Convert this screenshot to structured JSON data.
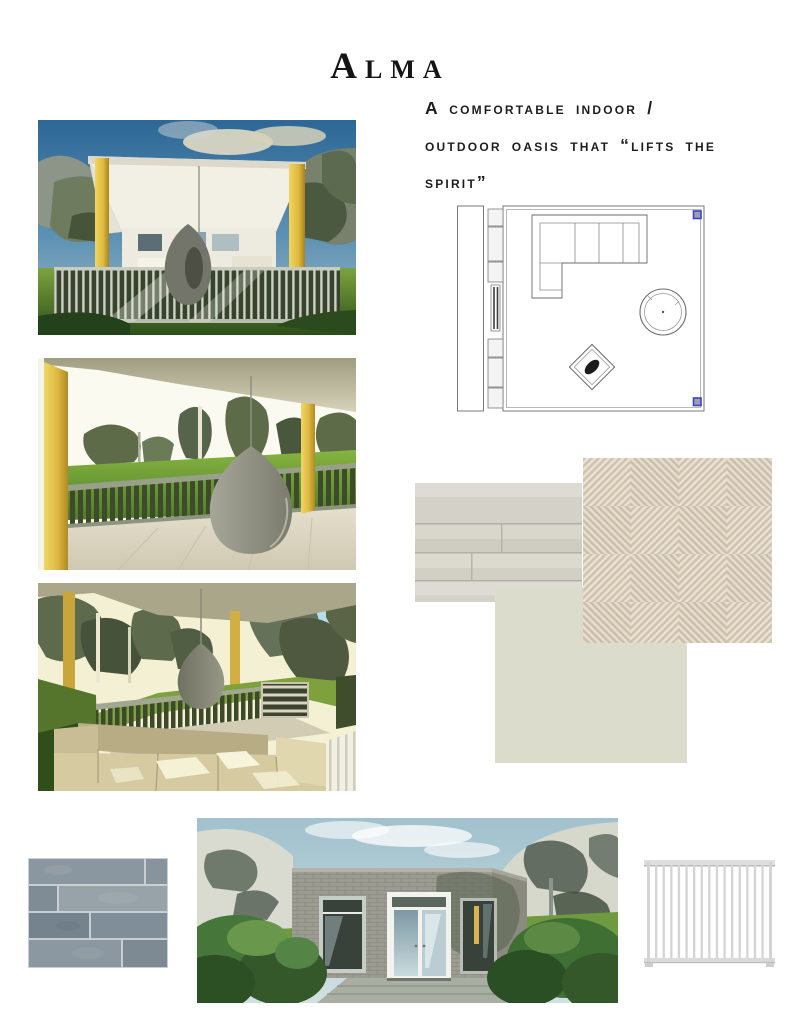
{
  "title": "Alma",
  "tagline": {
    "lines": [
      "A comfortable indoor /",
      "outdoor oasis that “lifts the",
      "spirit”"
    ]
  },
  "board": {
    "renders": [
      {
        "id": "render-pavilion-front",
        "desc": "Exterior render of covered patio pavilion with yellow columns, grey railing and hanging egg chair"
      },
      {
        "id": "render-porch-view",
        "desc": "Porch render looking out over dark green railing to lawn and trees, hanging egg chair at right"
      },
      {
        "id": "render-sectional-view",
        "desc": "Porch render with beige sectional sofa, hanging egg chair and slatted crate shelf"
      },
      {
        "id": "render-exterior-entry",
        "desc": "Exterior render of grey brick garden room with white glass double doors, shrubs and steps"
      }
    ],
    "floor_plan": {
      "id": "floor-plan",
      "desc": "Furniture plan with L-shaped sectional sofa, round swivel chair and angled side table"
    },
    "materials": [
      {
        "id": "swatch-whitewashed-wood",
        "desc": "Whitewashed wood plank flooring swatch",
        "color": "#d9d6cd"
      },
      {
        "id": "swatch-herringbone-fabric",
        "desc": "Beige herringbone weave fabric swatch",
        "color": "#ddd3c3"
      },
      {
        "id": "swatch-paint",
        "desc": "Soft greige paint swatch",
        "color": "#dcdccd"
      },
      {
        "id": "swatch-bluestone-tile",
        "desc": "Blue-grey stone subway tile swatch",
        "color": "#8c97a0"
      },
      {
        "id": "swatch-white-railing",
        "desc": "White vertical picket railing panel swatch",
        "color": "#d6d6d6"
      }
    ],
    "accent_colors": {
      "column_yellow": "#dcba4a",
      "grass_green": "#6f9a3f",
      "sky_blue": "#33719f"
    }
  }
}
